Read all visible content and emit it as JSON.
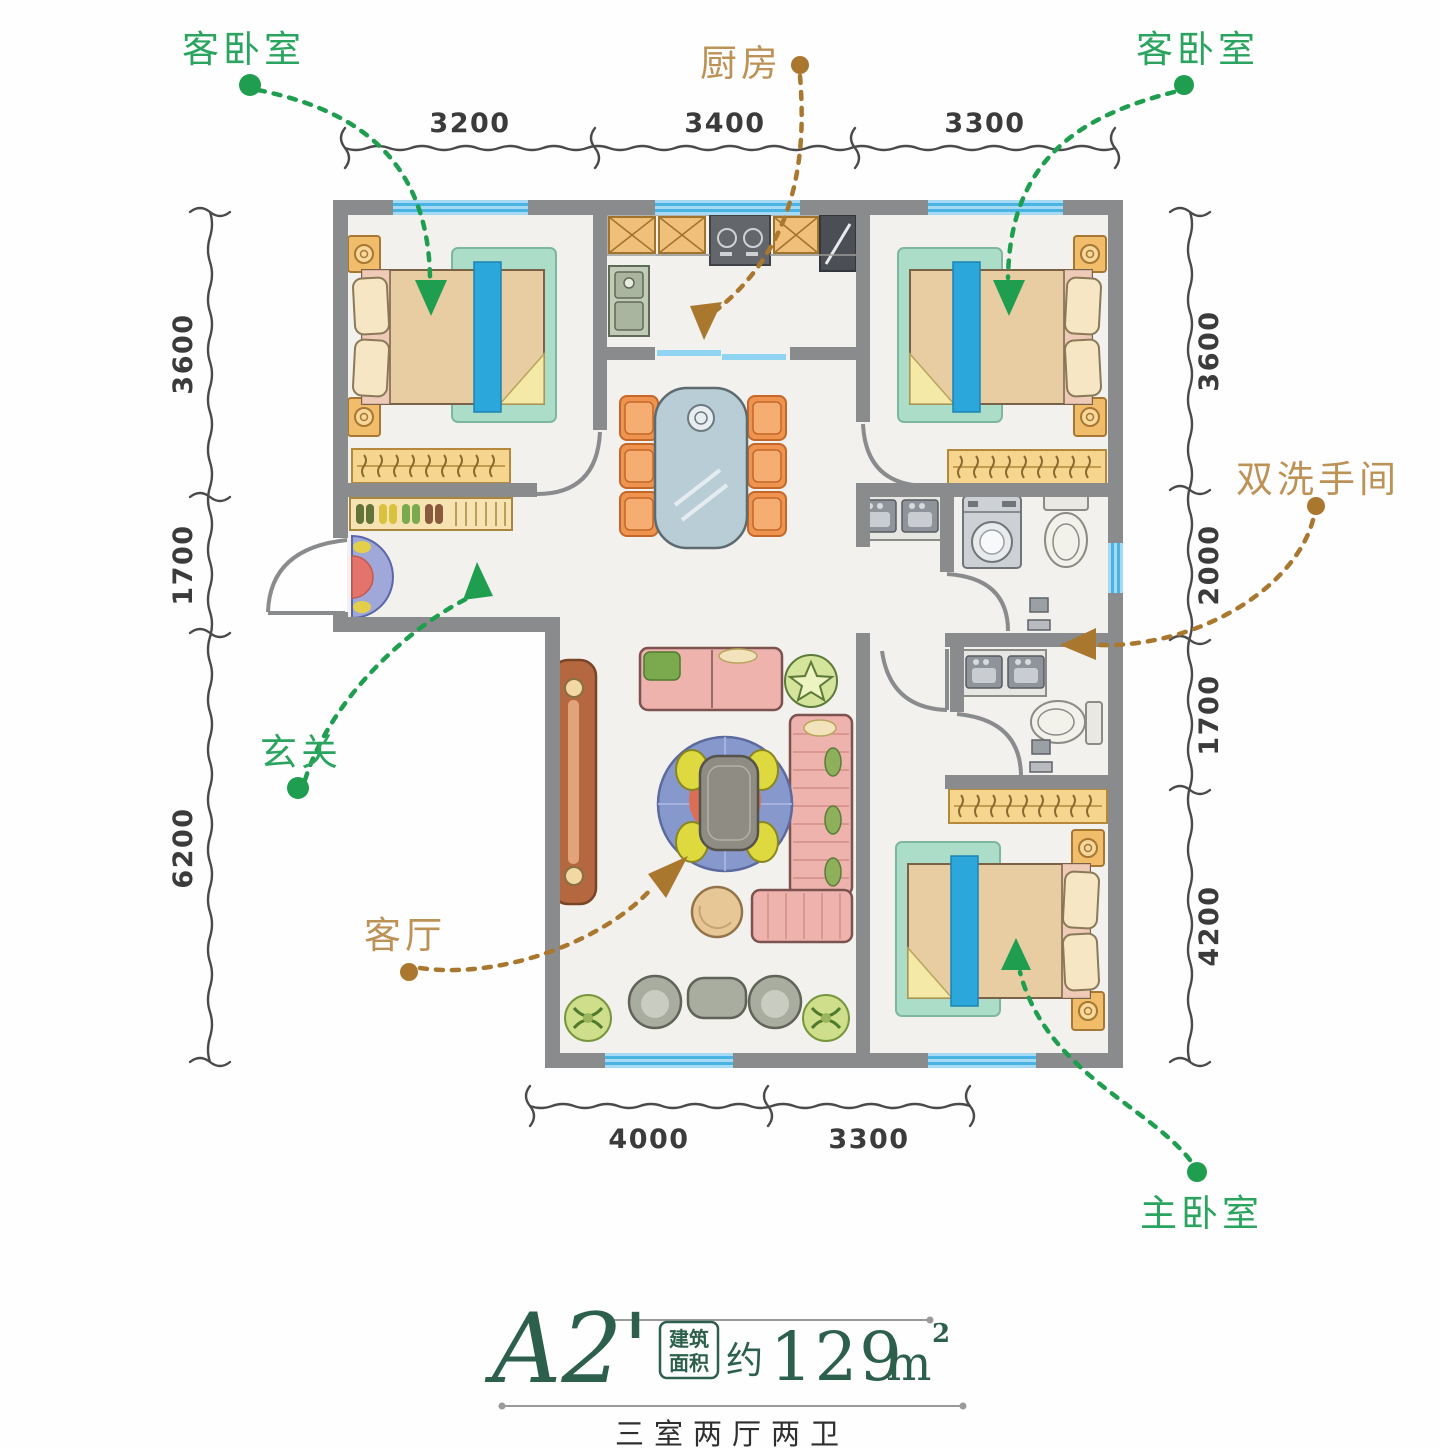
{
  "rooms": {
    "guest_bedroom_left": "客卧室",
    "kitchen": "厨房",
    "guest_bedroom_right": "客卧室",
    "double_bathroom": "双洗手间",
    "entrance": "玄关",
    "living_room": "客厅",
    "master_bedroom": "主卧室"
  },
  "dimensions": {
    "top": [
      "3200",
      "3400",
      "3300"
    ],
    "left": [
      "3600",
      "1700",
      "6200"
    ],
    "right": [
      "3600",
      "2000",
      "1700",
      "4200"
    ],
    "bottom": [
      "4000",
      "3300"
    ]
  },
  "title": {
    "unit_name": "A2'",
    "area_box_line1": "建筑",
    "area_box_line2": "面积",
    "approx_prefix": "约",
    "area_value": "129",
    "area_unit": "m",
    "area_exponent": "2",
    "layout_type": "三室两厅两卫"
  },
  "colors": {
    "label_green": "#2aa45e",
    "label_brown": "#bd9257",
    "arrow_green": "#1f9e50",
    "arrow_brown": "#a9772e",
    "wall_gray": "#8a8b8d",
    "window_blue": "#49b4e4",
    "title_green": "#2c5f4c"
  }
}
